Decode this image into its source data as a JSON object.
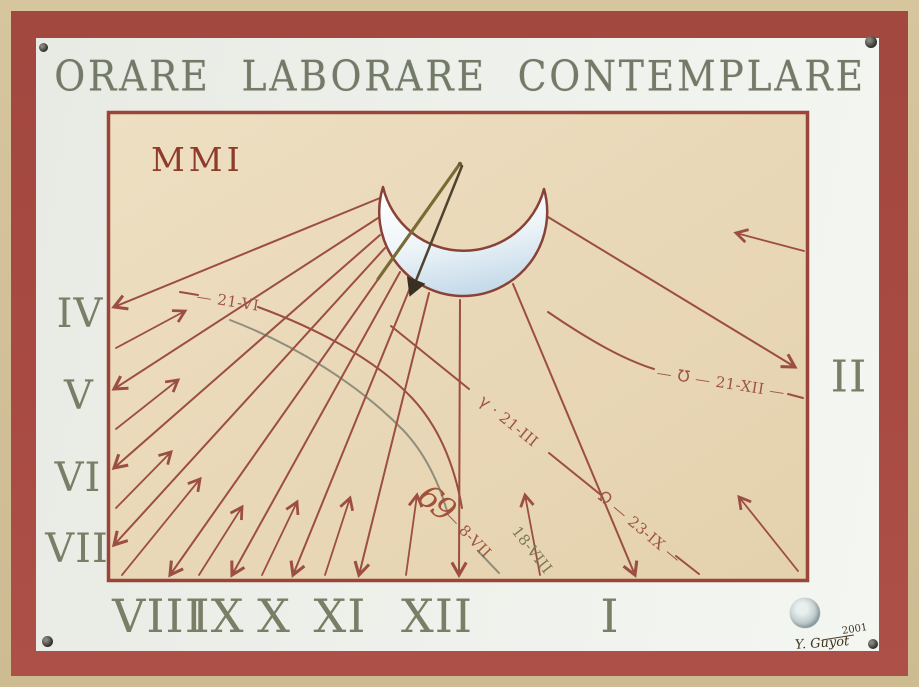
{
  "title": "ORARE LABORARE CONTEMPLARE",
  "year_inscription": "MMI",
  "hours": {
    "left": [
      "IV",
      "V",
      "VI",
      "VII"
    ],
    "bottom": [
      "VIII",
      "IX",
      "X",
      "XI",
      "XII",
      "I"
    ],
    "right": [
      "II"
    ]
  },
  "date_lines": {
    "summer_solstice": {
      "prefix": "— ",
      "date": "21-VI"
    },
    "spring_equinox": {
      "symbol": "γ",
      "symbol_name": "aries",
      "sep": " · ",
      "date": "21-III"
    },
    "autumn_equinox": {
      "symbol": "Ω",
      "symbol_name": "libra",
      "sep": " — ",
      "date": "23-IX",
      "suffix": " —"
    },
    "winter_solstice": {
      "prefix": "— ",
      "symbol": "℧",
      "symbol_name": "capricorn",
      "sep": " — ",
      "date": "21-XII",
      "suffix": " —"
    },
    "early_july": {
      "prefix": "— ",
      "date": "8-VII"
    },
    "mid_august": {
      "date": "18-VIII"
    },
    "cancer_mark": {
      "symbol": "69",
      "symbol_name": "cancer"
    }
  },
  "signature": {
    "artist": "Y. Guyot",
    "year": "2001"
  },
  "colors": {
    "frame_tan": "#d6c59d",
    "frame_red": "#a84a42",
    "panel_white": "#eff1ec",
    "dial_background": "#e9d8b7",
    "dial_line_red": "#9b4e41",
    "numeral_olive": "#7a7e66",
    "title_olive": "#747a68",
    "inscription_red": "#8e3b2b",
    "curve_gray": "#928e7c",
    "label_red": "#9d5440",
    "label_olive": "#7c7a56"
  }
}
